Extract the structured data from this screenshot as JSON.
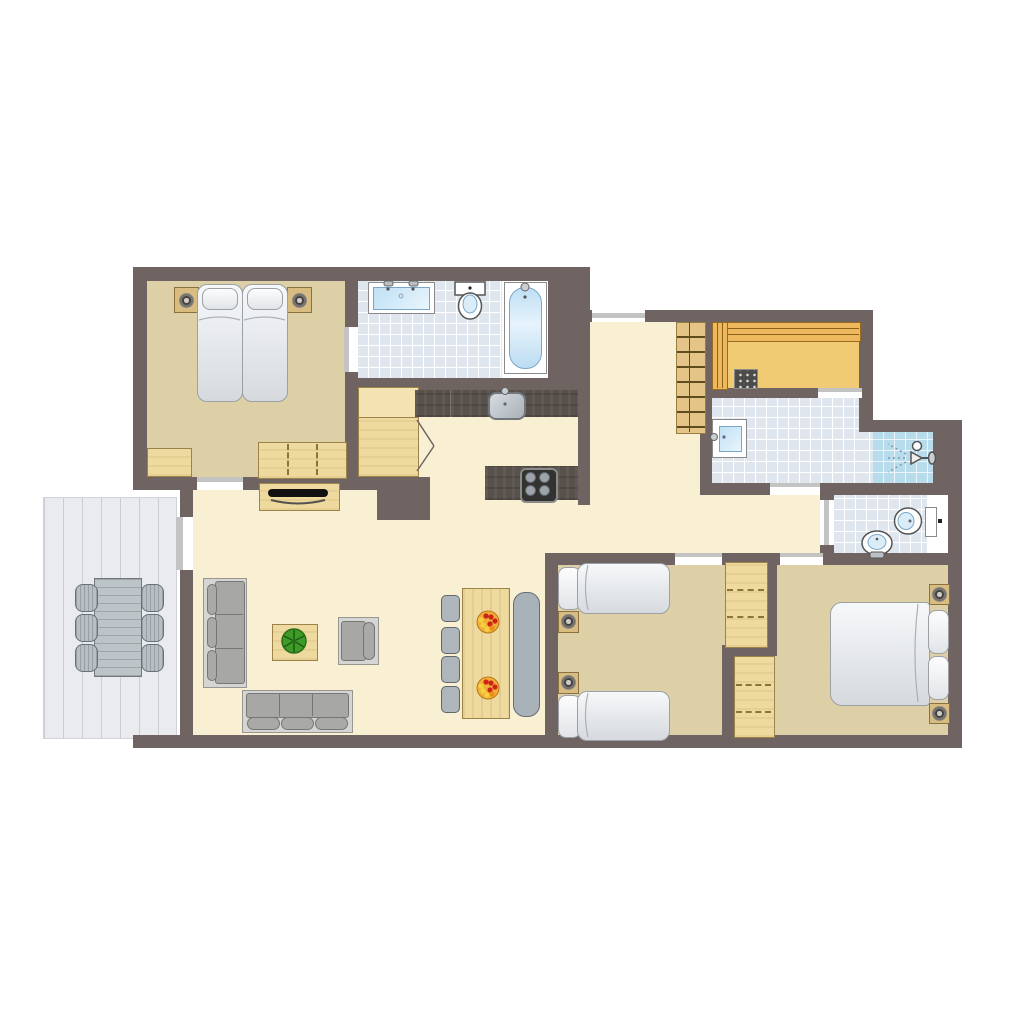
{
  "image": {
    "kind": "architectural-floor-plan",
    "style": "top-down 2D color illustration, no text labels",
    "background_color": "#ffffff"
  },
  "palette": {
    "wall": "#6f6462",
    "bedroom_floor_tan": "#ddd0a6",
    "living_floor_cream": "#f9f0d4",
    "bathroom_tile": "#dfe6ee",
    "shower_cubicle_blue": "#b9dcec",
    "sauna_floor_amber": "#f1cb74",
    "sauna_bench": "#eeb95e",
    "terrace_deck_gray": "#e9ebee",
    "kitchen_counter_dark": "#57504b",
    "wood_furniture": "#eeda9f",
    "upholstery_gray": "#a7a7a5",
    "mattress_white": "#f0f3f5",
    "fixture_water_blue": "#bfe0f5",
    "door_window_marker": "#c3c3c3",
    "plant_green": "#3f9b28",
    "fruit_bowl_orange": "#f2ae39"
  },
  "rooms": [
    {
      "id": "bedroom-master",
      "location": "top-left",
      "floor": "tan",
      "furniture": [
        "double bed with two mattresses and two pillows",
        "two nightstands with lamps",
        "sliding-door wardrobe",
        "low cabinet"
      ]
    },
    {
      "id": "bathroom-main",
      "location": "top-middle",
      "floor": "light-blue tile",
      "fixtures": [
        "double washbasin vanity",
        "toilet",
        "bathtub in white alcove"
      ]
    },
    {
      "id": "hallway",
      "location": "center",
      "floor": "cream",
      "features": [
        "built-in closet with hinged doors",
        "loft ladder",
        "entrance door-window at top wall"
      ]
    },
    {
      "id": "kitchen",
      "location": "center",
      "floor": "cream",
      "fixtures": [
        "dark wall counter with sink",
        "dark island counter with 4-burner hob"
      ]
    },
    {
      "id": "sauna",
      "location": "top-right",
      "floor": "amber wood",
      "features": [
        "bench along top wall",
        "bench along left wall",
        "sauna heater with stones"
      ]
    },
    {
      "id": "shower-room",
      "location": "right",
      "floor": "light-blue tile",
      "fixtures": [
        "washbasin",
        "corner shower cubicle with sprayer"
      ]
    },
    {
      "id": "bathroom-small",
      "location": "right",
      "floor": "light-blue tile",
      "fixtures": [
        "toilet",
        "small washbasin"
      ]
    },
    {
      "id": "bedroom-twin",
      "location": "bottom-middle",
      "floor": "tan",
      "furniture": [
        "two single beds with pillows",
        "two nightstands with lamps",
        "wardrobe with sliding doors"
      ]
    },
    {
      "id": "bedroom-double",
      "location": "bottom-right",
      "floor": "tan",
      "furniture": [
        "double bed with two pillows",
        "two nightstands with lamps",
        "wardrobe with sliding doors"
      ]
    },
    {
      "id": "living-room",
      "location": "bottom-left",
      "floor": "cream",
      "furniture": [
        "three-seat sofa vertical",
        "three-seat sofa horizontal",
        "armchair",
        "coffee table with potted plant",
        "TV cabinet with television"
      ]
    },
    {
      "id": "dining-area",
      "location": "bottom-center",
      "floor": "cream",
      "furniture": [
        "wooden dining table with two fruit bowls",
        "four gray chairs",
        "gray bench"
      ]
    },
    {
      "id": "terrace",
      "location": "outside-left",
      "floor": "gray plank deck",
      "furniture": [
        "outdoor table",
        "six outdoor chairs"
      ]
    }
  ],
  "openings": [
    "master bedroom to living room sliding door",
    "master bedroom to bathroom sliding door",
    "entrance door-window at hallway top wall",
    "sauna to shower room door",
    "shower room to hallway door",
    "small bathroom to hallway door",
    "twin bedroom to hallway door",
    "double bedroom to hallway door",
    "living room to terrace sliding door"
  ]
}
